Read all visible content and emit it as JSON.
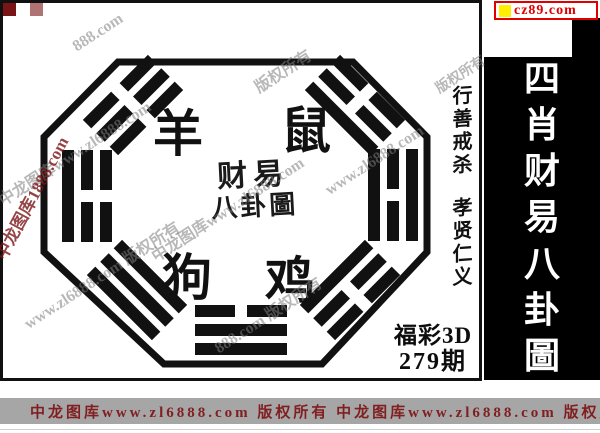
{
  "site_link": {
    "label": "cz89.com"
  },
  "banner": {
    "title": "四肖财易八卦圖",
    "chars": [
      "四",
      "肖",
      "财",
      "易",
      "八",
      "卦",
      "圖"
    ]
  },
  "frame": {
    "animals": {
      "top_left": "羊",
      "top_right": "鼠",
      "bottom_left": "狗",
      "bottom_right": "鸡"
    },
    "seal": {
      "line1": "财易",
      "line2": "八卦圖"
    },
    "motto": {
      "part1": "行善戒杀",
      "part2": "孝贤仁义"
    },
    "issue": {
      "game": "福彩3D",
      "period": "279期"
    }
  },
  "watermarks": {
    "items": [
      "中龙图库www.zl6888.com",
      "www.zl6888.com 版权所有",
      "中龙图库www.zl6888.com",
      "版权所有",
      "888.com 版权所有",
      "www.zl6888.com",
      "888.com",
      "版权所有"
    ],
    "left_red": "中龙图库1888.com"
  },
  "footer": {
    "text": "中龙图库www.zl6888.com 版权所有 中龙图库www.zl6888.com 版权所有"
  },
  "colors": {
    "accent_red": "#e00000",
    "marker_yellow": "#ffee00",
    "maroon": "#7a1517",
    "banner_bg": "#000000",
    "watermark_gray": "#9a9a9a",
    "footer_bg": "#a6a6a6"
  }
}
